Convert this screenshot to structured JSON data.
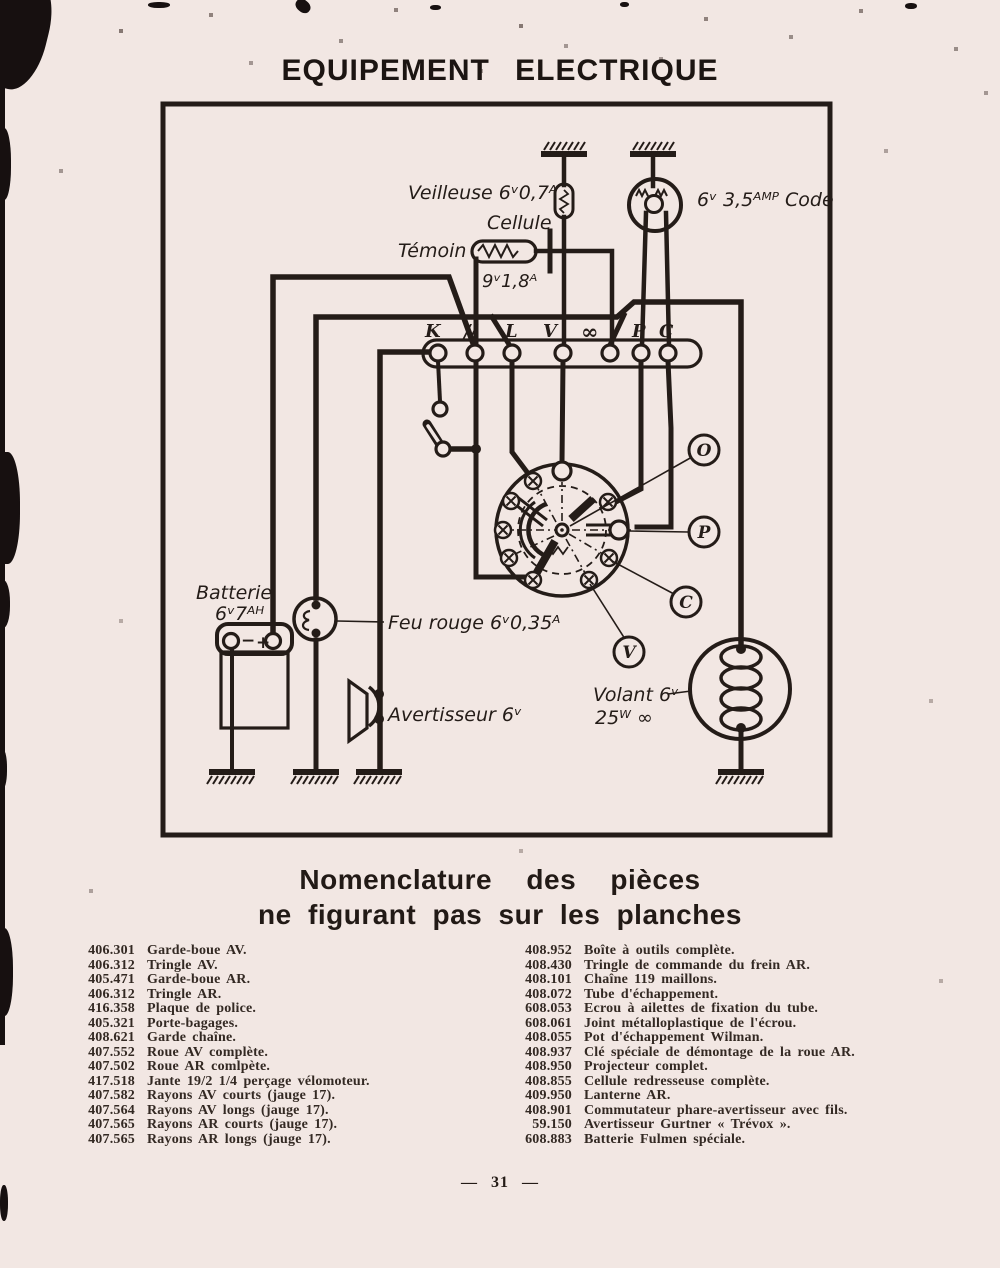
{
  "colors": {
    "paper": "#f2e7e3",
    "ink": "#241c18"
  },
  "page": {
    "title": "EQUIPEMENT ELECTRIQUE",
    "page_number": "— 31 —"
  },
  "diagram": {
    "labels": {
      "veilleuse": "Veilleuse 6ᵛ0,7ᴬ",
      "cellule": "Cellule",
      "temoin": "Témoin",
      "cellule_rating": "9ᵛ1,8ᴬ",
      "code": "6ᵛ 3,5ᴬᴹᴾ Code",
      "batterie_1": "Batterie",
      "batterie_2": "6ᵛ7ᴬᴴ",
      "feu_rouge": "Feu rouge 6ᵛ0,35ᴬ",
      "avertisseur": "Avertisseur 6ᵛ",
      "volant_1": "Volant 6ᵛ",
      "volant_2": "25ᵂ ∞"
    },
    "terminals": [
      "K",
      "//",
      "L",
      "V",
      "∞",
      "P",
      "C"
    ],
    "callouts": [
      "O",
      "P",
      "C",
      "V"
    ]
  },
  "nomenclature": {
    "heading_line1": "Nomenclature des pièces",
    "heading_line2": "ne figurant pas sur les planches",
    "left": [
      {
        "ref": "406.301",
        "desc": "Garde-boue AV."
      },
      {
        "ref": "406.312",
        "desc": "Tringle AV."
      },
      {
        "ref": "405.471",
        "desc": "Garde-boue AR."
      },
      {
        "ref": "406.312",
        "desc": "Tringle AR."
      },
      {
        "ref": "416.358",
        "desc": "Plaque de police."
      },
      {
        "ref": "405.321",
        "desc": "Porte-bagages."
      },
      {
        "ref": "408.621",
        "desc": "Garde chaîne."
      },
      {
        "ref": "407.552",
        "desc": "Roue AV complète."
      },
      {
        "ref": "407.502",
        "desc": "Roue AR comlpète."
      },
      {
        "ref": "417.518",
        "desc": "Jante 19/2 1/4 perçage vélomoteur."
      },
      {
        "ref": "407.582",
        "desc": "Rayons AV courts (jauge 17)."
      },
      {
        "ref": "407.564",
        "desc": "Rayons AV longs (jauge 17)."
      },
      {
        "ref": "407.565",
        "desc": "Rayons AR courts (jauge 17)."
      },
      {
        "ref": "407.565",
        "desc": "Rayons AR longs (jauge 17)."
      }
    ],
    "right": [
      {
        "ref": "408.952",
        "desc": "Boîte à outils complète."
      },
      {
        "ref": "408.430",
        "desc": "Tringle de commande du frein AR."
      },
      {
        "ref": "408.101",
        "desc": "Chaîne 119 maillons."
      },
      {
        "ref": "408.072",
        "desc": "Tube d'échappement."
      },
      {
        "ref": "608.053",
        "desc": "Ecrou à ailettes de fixation du tube."
      },
      {
        "ref": "608.061",
        "desc": "Joint métalloplastique de l'écrou."
      },
      {
        "ref": "408.055",
        "desc": "Pot d'échappement Wilman."
      },
      {
        "ref": "408.937",
        "desc": "Clé spéciale de démontage de la roue AR."
      },
      {
        "ref": "408.950",
        "desc": "Projecteur complet."
      },
      {
        "ref": "408.855",
        "desc": "Cellule redresseuse complète."
      },
      {
        "ref": "409.950",
        "desc": "Lanterne AR."
      },
      {
        "ref": "408.901",
        "desc": "Commutateur phare-avertisseur avec fils."
      },
      {
        "ref": "59.150",
        "desc": "Avertisseur Gurtner « Trévox »."
      },
      {
        "ref": "608.883",
        "desc": "Batterie Fulmen spéciale."
      }
    ]
  }
}
